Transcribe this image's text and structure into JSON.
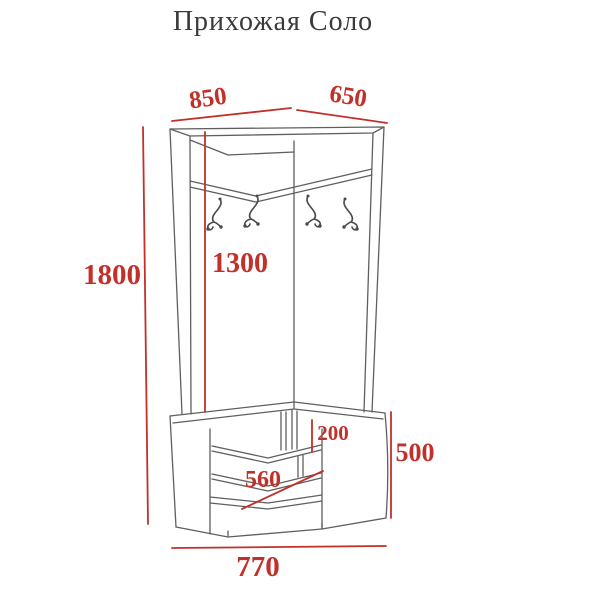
{
  "title": "Прихожая Соло",
  "colors": {
    "dimension_red": "#c2302a",
    "outline_gray": "#5f5f5f",
    "hook_gray": "#4a4a4a",
    "title_color": "#3a3a3a",
    "background": "#ffffff"
  },
  "dimensions_mm": {
    "top_width_left": "850",
    "top_width_right": "650",
    "overall_height": "1800",
    "open_section_height": "1300",
    "shelf_drop": "200",
    "shelf_depth": "560",
    "cabinet_height": "500",
    "base_width": "770"
  },
  "hooks": {
    "count": 4
  }
}
